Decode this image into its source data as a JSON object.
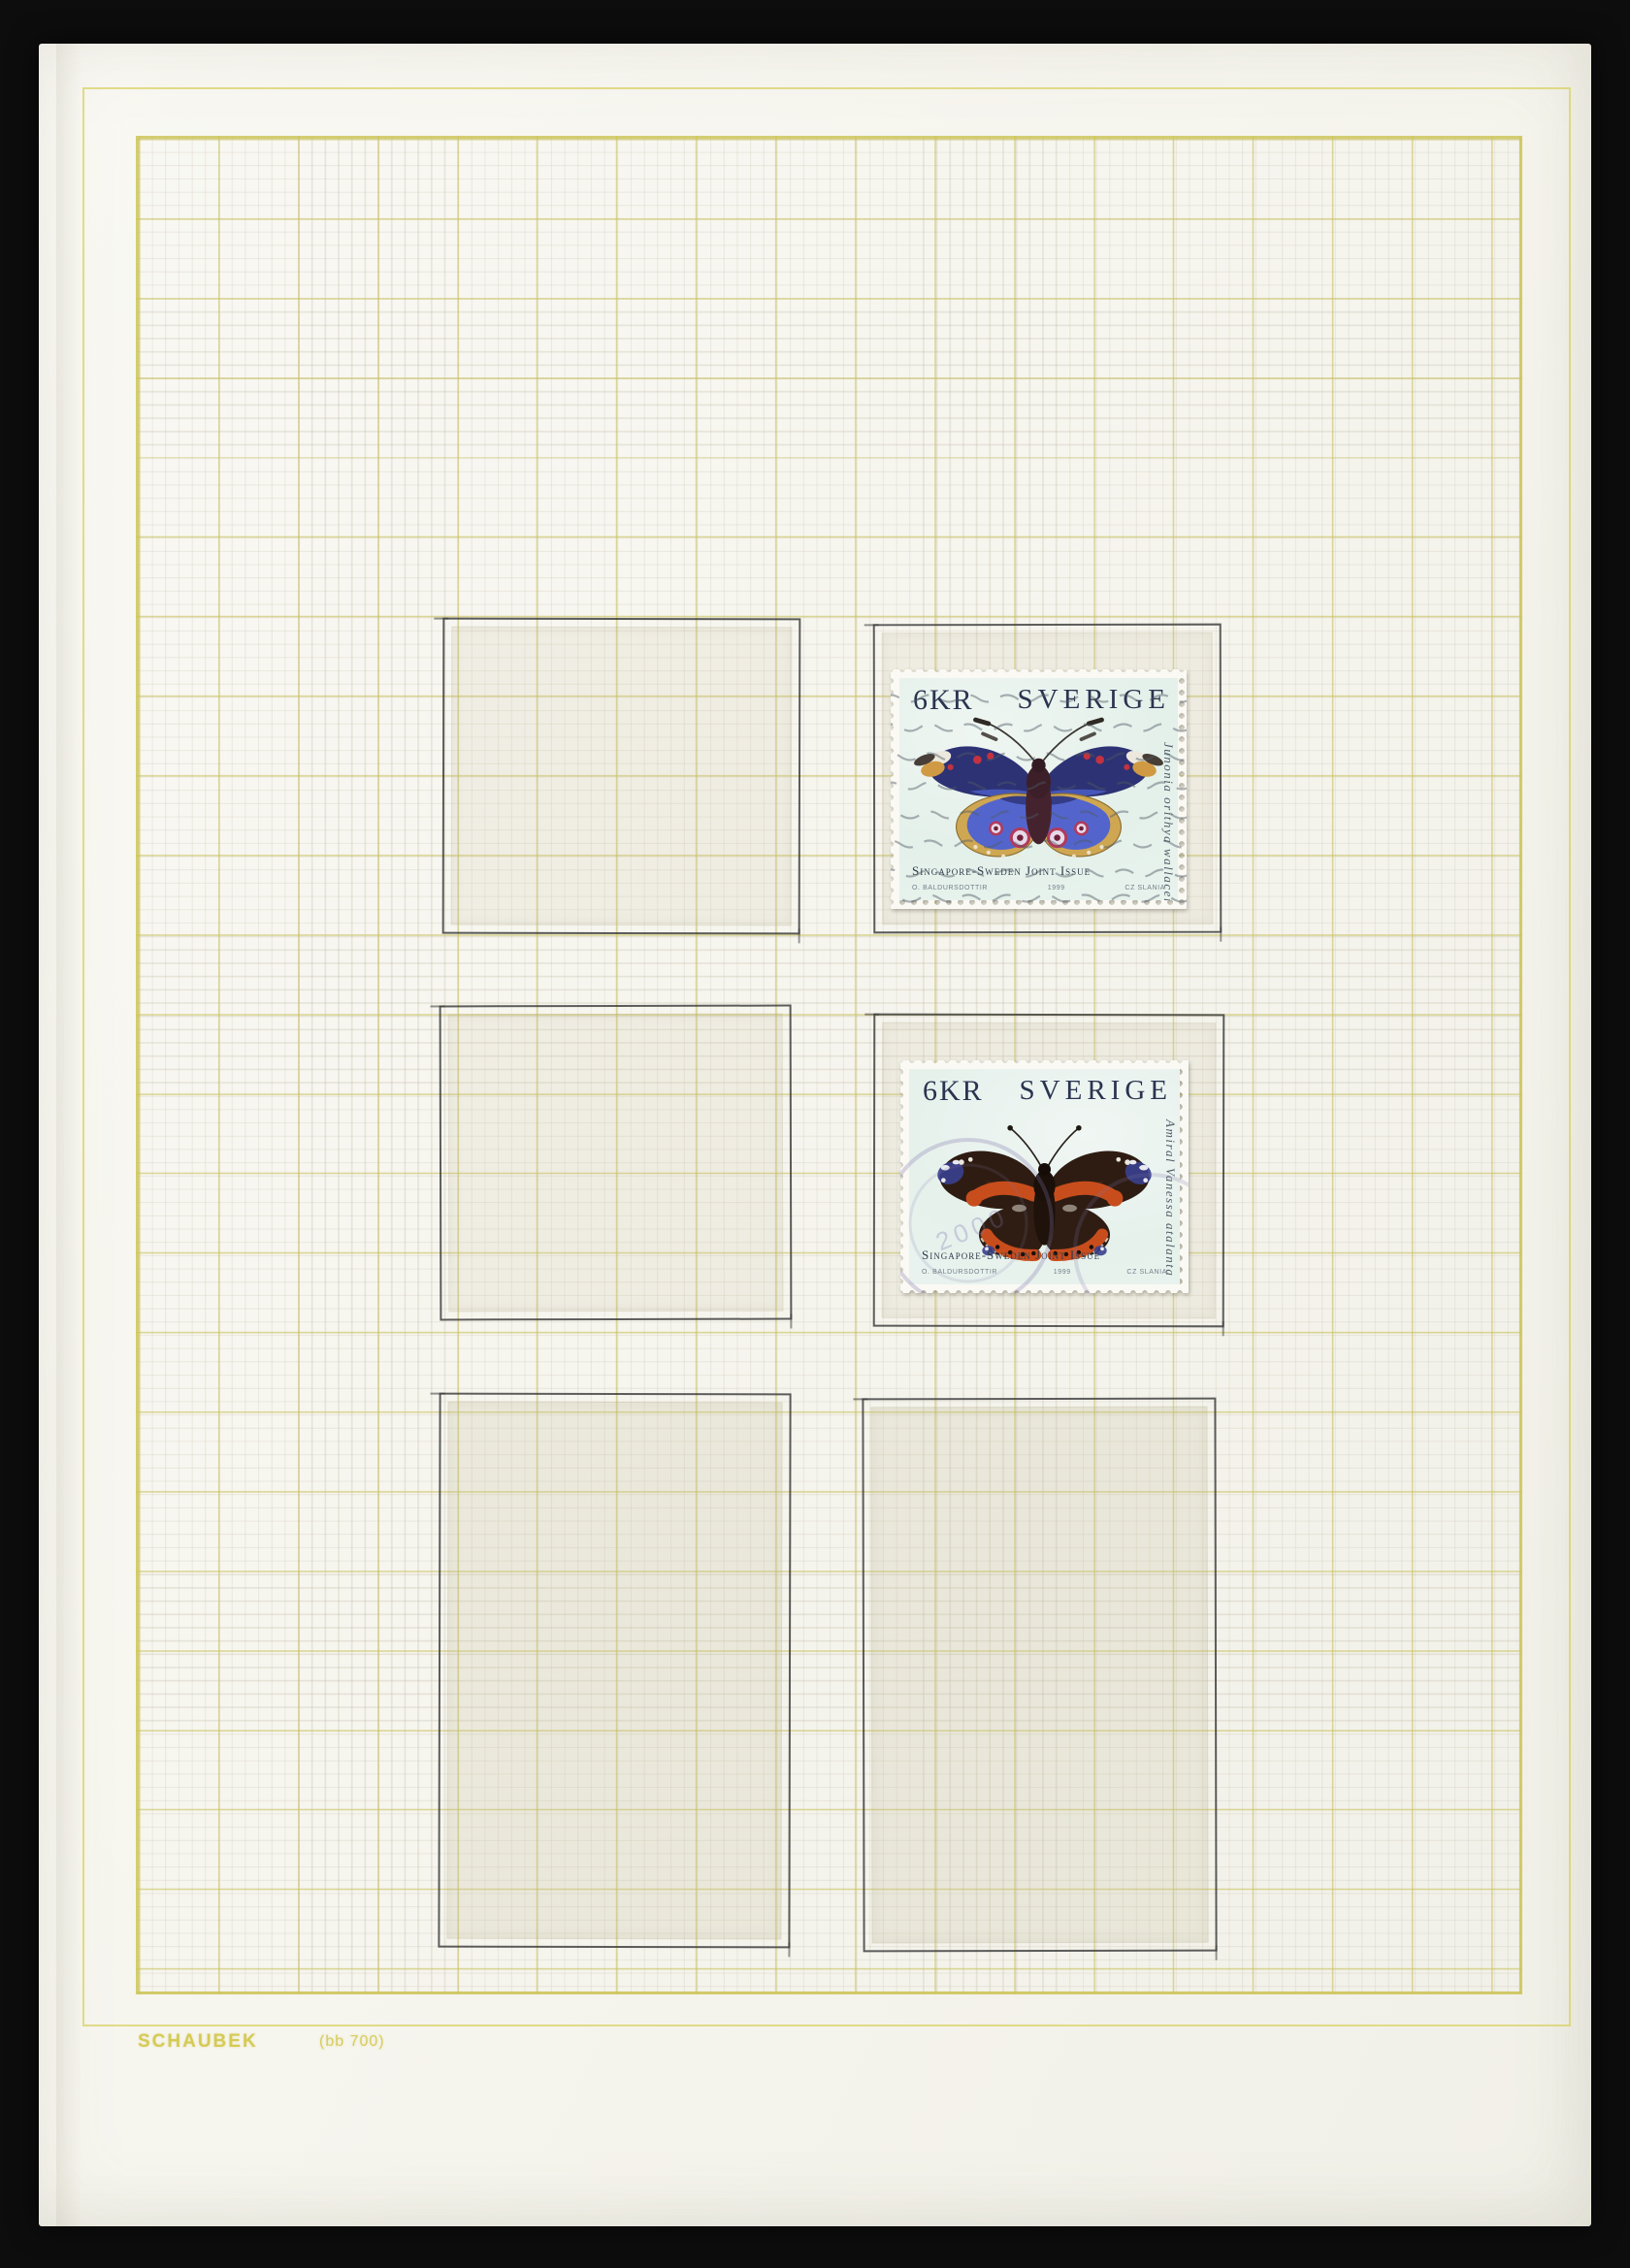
{
  "photo": {
    "background_color": "#0d0d0d",
    "paper_color": "#f6f5ee",
    "grid_line_color": "#cfc75f",
    "pencil_color": "#3f3f3f",
    "brand_text_color": "#d3c74a"
  },
  "album_page": {
    "brand": "SCHAUBEK",
    "reference": "(bb 700)"
  },
  "stamps": [
    {
      "denomination": "6KR",
      "country": "SVERIGE",
      "issue_caption": "Singapore-Sweden Joint Issue",
      "designer": "O. Baldursdottir",
      "year": "1999",
      "engraver": "Cz Slania",
      "species": "Junonia orithya wallacei",
      "cancellation": "wavy-line-machine-cancel",
      "colors": {
        "paper": "#e7f1ec",
        "wing_blue": "#5163c8",
        "wing_navy": "#2c3173",
        "margin_gold": "#cfa753",
        "spot_red": "#c23240",
        "body_brown": "#4c2731",
        "text": "#2a3450"
      }
    },
    {
      "denomination": "6KR",
      "country": "SVERIGE",
      "issue_caption": "Singapore-Sweden Joint Issue",
      "designer": "O. Baldursdottir",
      "year": "1999",
      "engraver": "Cz Slania",
      "species": "Amiral Vanessa atalanta",
      "cancellation": "circular-date-postmark",
      "postmark_digits": "2000",
      "colors": {
        "paper": "#e9f2ee",
        "wing_dark": "#2e1c12",
        "band_orange": "#c84d1d",
        "tip_navy": "#3a3f8c",
        "body_dark": "#241610",
        "text": "#2a3450"
      }
    }
  ]
}
